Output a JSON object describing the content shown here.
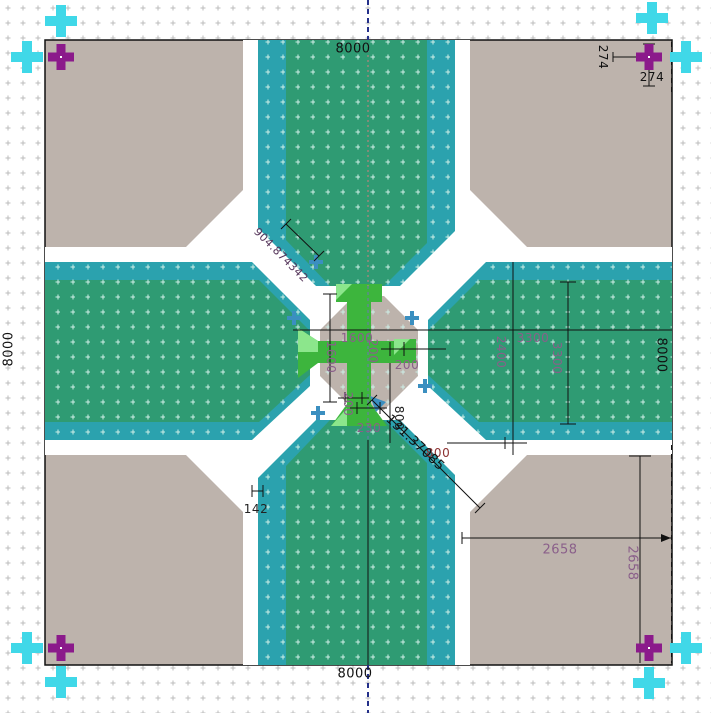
{
  "app": {
    "view": "cad-layout-viewport",
    "description": "Chip/mask layout cross intersection with dimension annotations"
  },
  "colors": {
    "background": "#ffffff",
    "die_gray": "#bdb3ac",
    "arm_green": "#2f9b73",
    "arm_teal": "#2ba2ae",
    "cross_green": "#3db53d",
    "cross_pale_green": "#8ce68c",
    "fiducial_purple": "#8b1a8b",
    "fiducial_cyan": "#40d8e8",
    "marker_steel_blue": "#3b8fc0",
    "dim_text_purple": "#8a5f8a",
    "dim_text_maroon": "#8b3030",
    "centerline_navy": "#24308a",
    "grid_dot_gray": "#bcbcbc",
    "grid_dot_cyan": "#cdeee6"
  },
  "dims": {
    "die_top": "8000",
    "die_bottom": "8000",
    "die_left": "8000",
    "die_right": "8000",
    "fiducial_offset_v": "274",
    "fiducial_offset_h": "274",
    "quadrant_width": "2658",
    "quadrant_height": "2658",
    "street_width": "142",
    "core_width": "1600",
    "core_height": "1600",
    "bar_width": "200",
    "pad_width": "200",
    "stub_length": "200",
    "stub_width": "230",
    "channel_length": "800",
    "channel_width": "800",
    "via_offset": "2400",
    "span_horizontal": "3300",
    "span_vertical": "3300",
    "diag_top": "904.874342",
    "diag_bottom": "131.37085"
  },
  "markers": {
    "purple_fiducials": 4,
    "cyan_fiducials": 8,
    "steel_blue_crosses": 5
  }
}
